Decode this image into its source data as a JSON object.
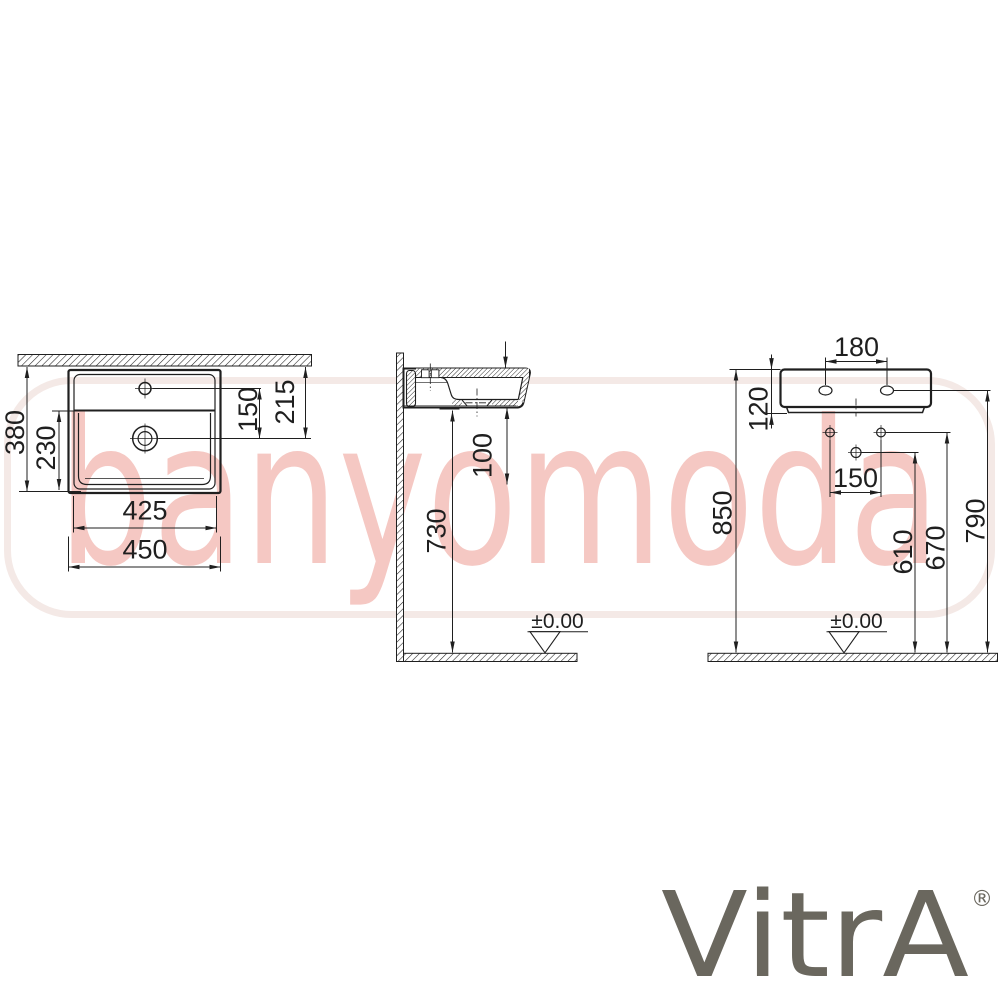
{
  "watermark": {
    "text": "banyomoda"
  },
  "brand": {
    "logo": "VitrA",
    "registered": "®"
  },
  "plan_view": {
    "depth_total": "380",
    "bowl_depth": "230",
    "faucet_to_drain": "150",
    "rim_to_drain": "215",
    "bowl_width": "425",
    "width_total": "450"
  },
  "side_view": {
    "underside_to_floor": "730",
    "drain_drop": "100",
    "floor_level": "±0.00"
  },
  "front_view": {
    "tap_hole_spacing": "180",
    "body_height": "120",
    "supply_spacing": "150",
    "rim_height": "850",
    "drain_height": "610",
    "supply_height": "670",
    "fixing_hole_height": "790",
    "floor_level": "±0.00"
  },
  "colors": {
    "line": "#1f1f1f",
    "wmtext": "#f5c8c3",
    "wmbox": "#f4e9e6",
    "logo": "#6a675e"
  }
}
